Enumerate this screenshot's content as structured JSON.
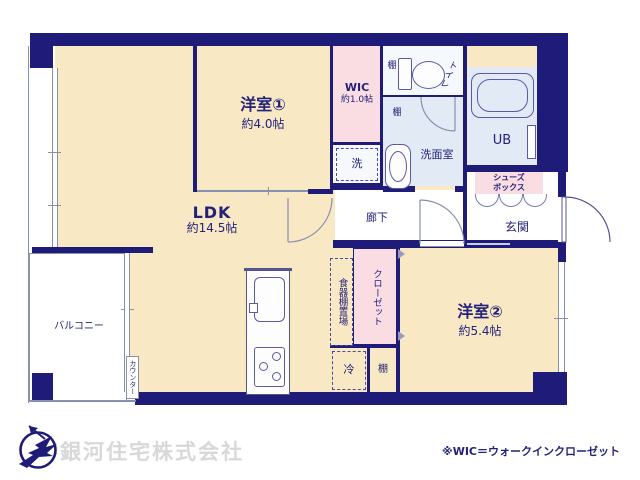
{
  "colors": {
    "wall_navy": "#1e1c78",
    "room_cream": "#f8e8c4",
    "accent_pink": "#fadde3",
    "wet_blue": "#e2eaf5",
    "toilet_white": "#f5f8fc",
    "line_gray": "#8890b0",
    "text_navy": "#23227a",
    "company_gray": "#d8d8d8"
  },
  "rooms": {
    "yoshitsu1": {
      "name": "洋室①",
      "size": "約4.0帖"
    },
    "yoshitsu2": {
      "name": "洋室②",
      "size": "約5.4帖"
    },
    "ldk": {
      "name": "LDK",
      "size": "約14.5帖"
    },
    "wic": {
      "name": "WIC",
      "size": "約1.0帖"
    },
    "balcony": "バルコニー",
    "hallway": "廊下",
    "entrance": "玄関",
    "washroom": "洗面室",
    "toilet": "トイレ",
    "unit_bath": "UB"
  },
  "fixtures": {
    "shelf_top": "棚",
    "shelf_mid": "棚",
    "shelf_bottom": "棚",
    "laundry": "洗",
    "fridge": "冷",
    "counter": "カウンター",
    "cupboard_space": "食器棚置場",
    "closet": "クローゼット",
    "shoebox_line1": "シューズ",
    "shoebox_line2": "ボックス"
  },
  "footer": {
    "company": "銀河住宅株式会社",
    "note": "※WIC＝ウォークインクローゼット"
  }
}
